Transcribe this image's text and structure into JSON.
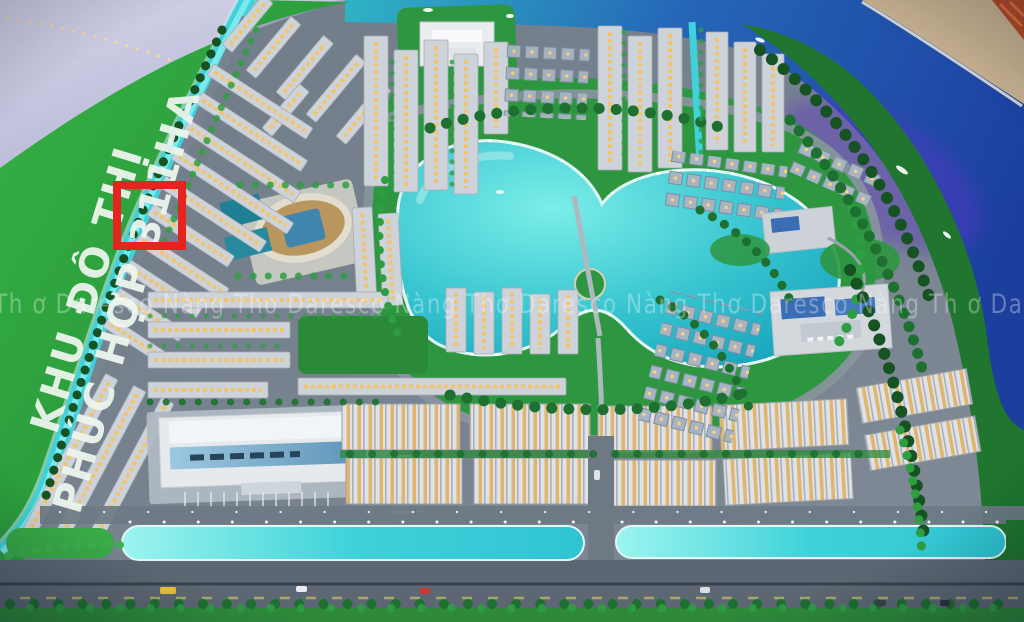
{
  "land_label": {
    "line1": "KHU ĐÔ THỊ",
    "line2": "PHÚC HỢP 311HA",
    "color": "#edf5ee"
  },
  "watermark": {
    "text": "Th ơ Daresco Nàng Thơ Daresco Nàng Thơ Daresco Nàng Thơ Daresco Nàng Th ơ Dar",
    "color": "#ffffff"
  },
  "annotation": {
    "highlight_color": "#e52420"
  },
  "palette": {
    "lawn_green": "#2fa23f",
    "park_green": "#2e9641",
    "forest_green": "#20752f",
    "canal_teal": "#3fd2da",
    "lake_teal": "#21b4c6",
    "river_blue": "#1d4ea6",
    "river_glow_purple": "#5b35c8",
    "building_gray": "#ced3da",
    "window_gold": "#f2c469",
    "road_gray": "#6e7984",
    "sand_tan": "#c6b08f",
    "model_edge_lavender": "#c9c8e0"
  }
}
